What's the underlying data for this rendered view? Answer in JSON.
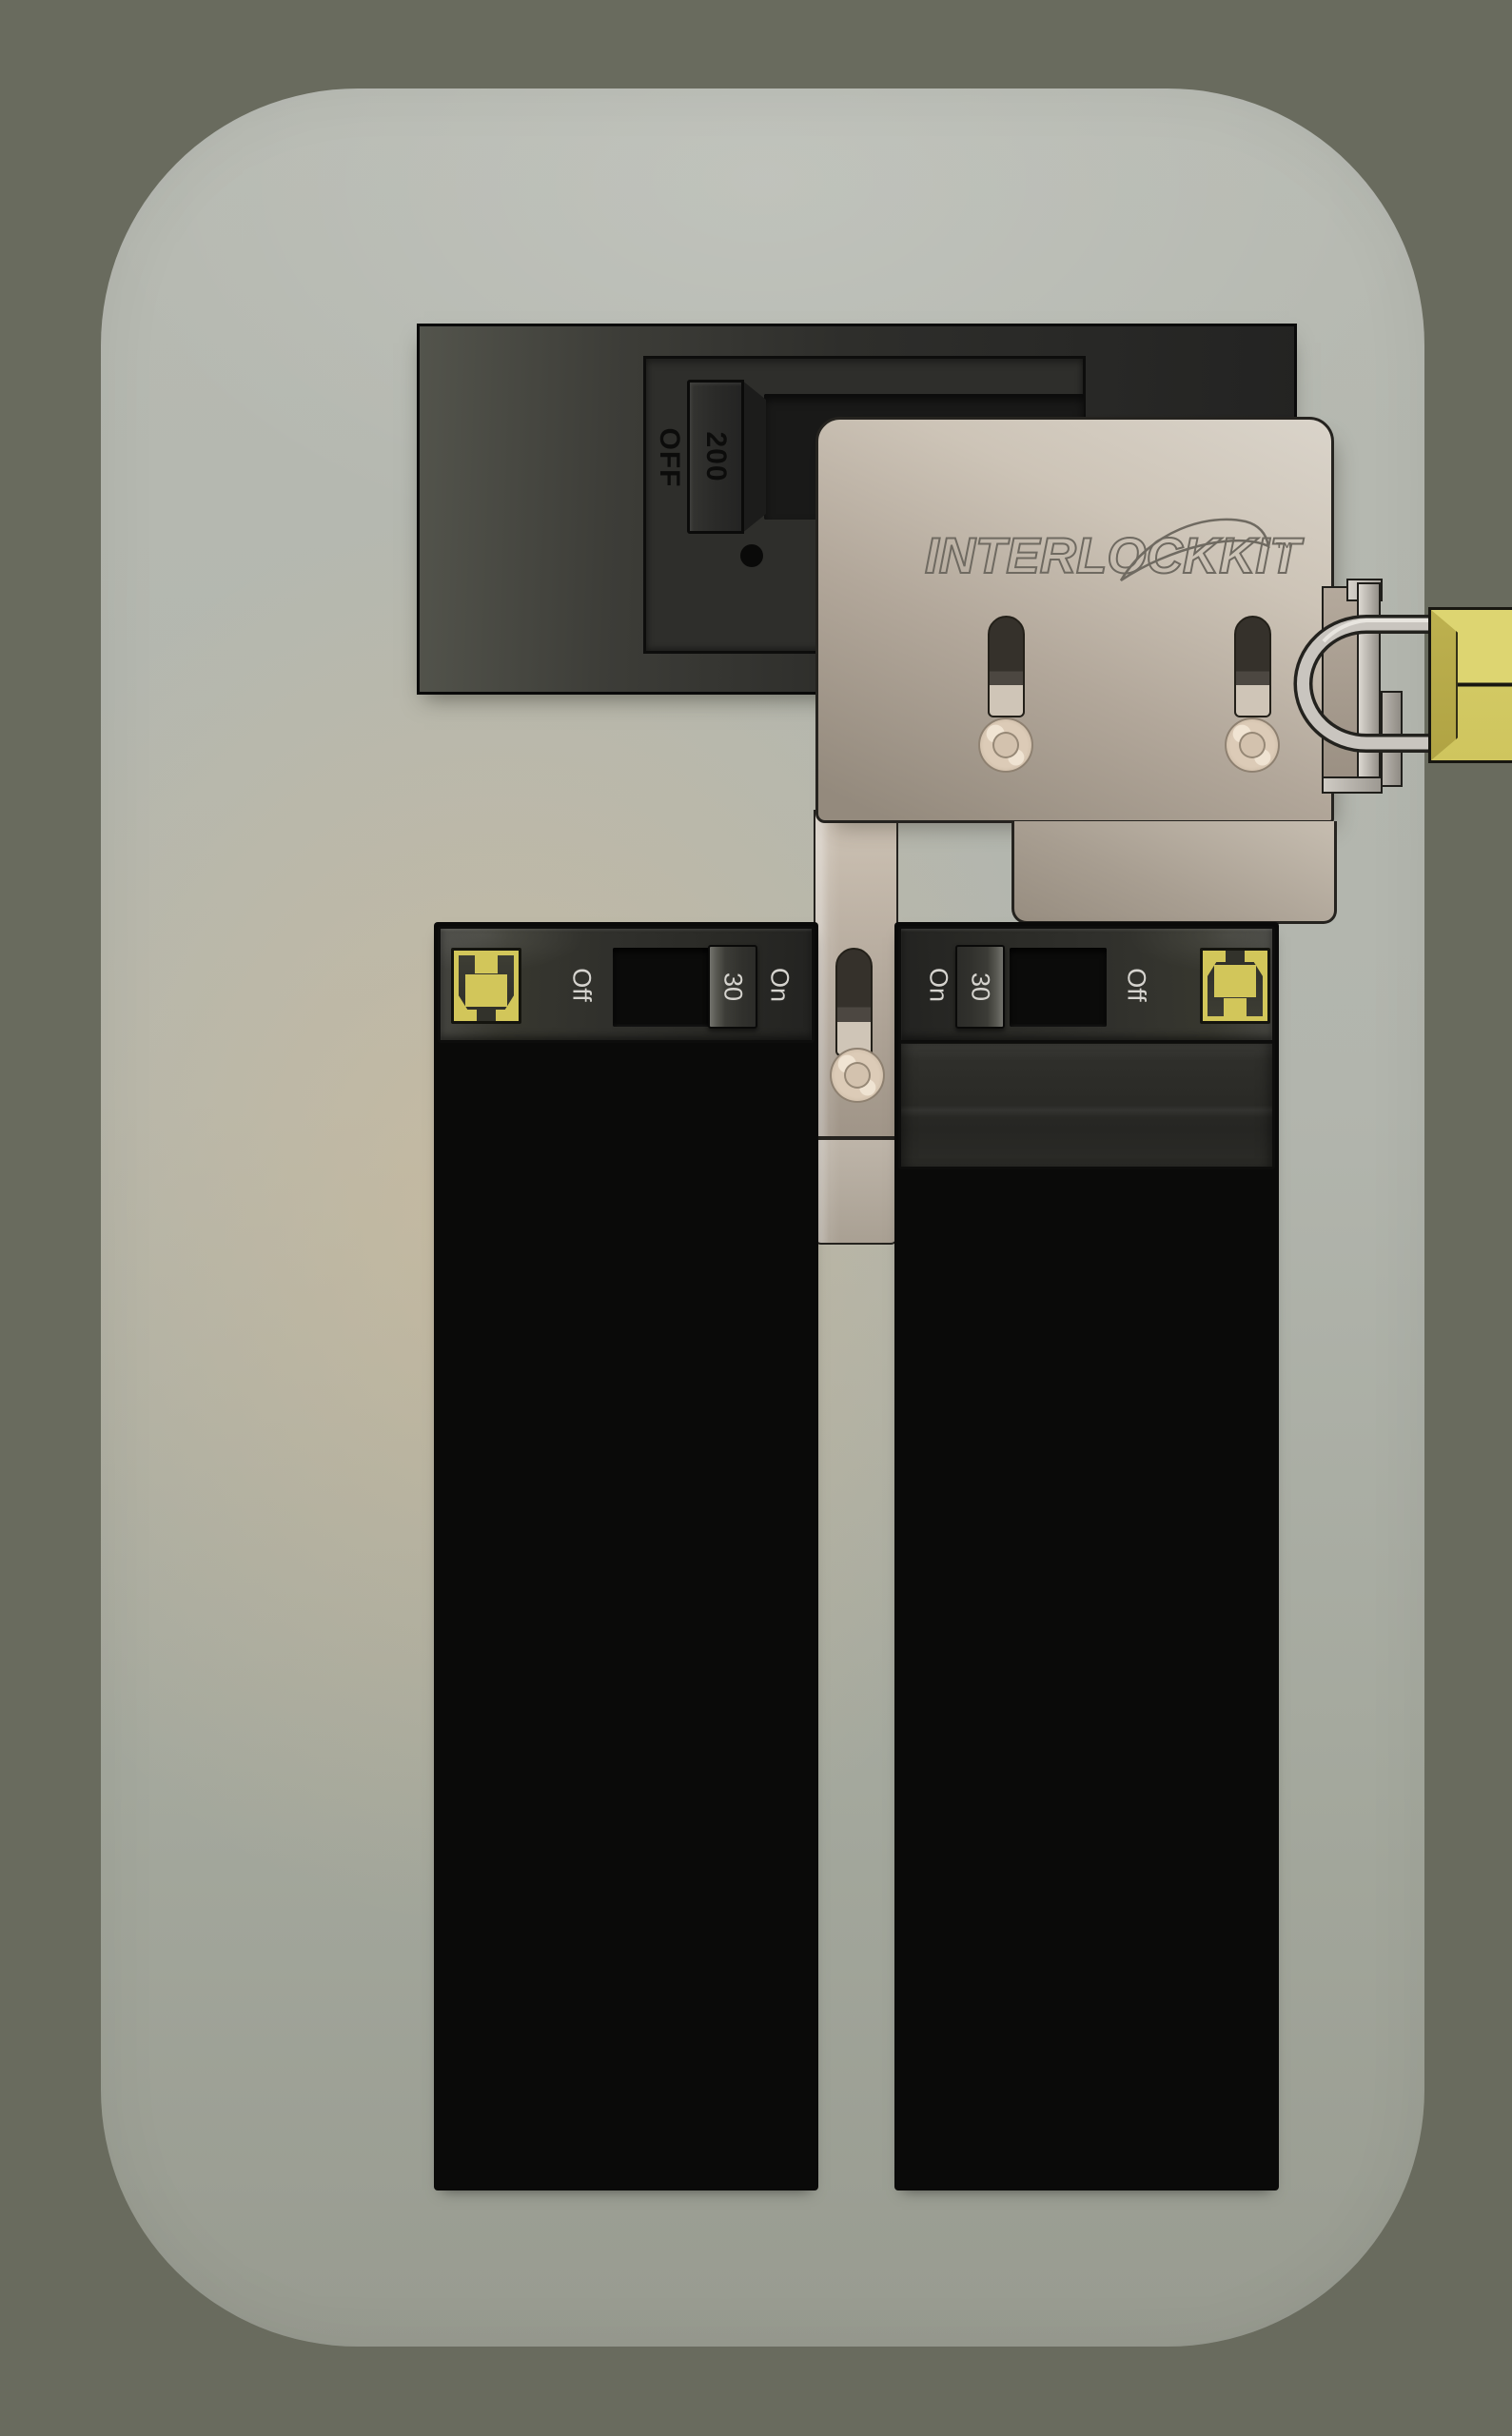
{
  "main_breaker": {
    "rating": "200",
    "state": "OFF"
  },
  "interlock_kit": {
    "brand": "INTERLOCKKIT",
    "trademark": "™"
  },
  "left_column": {
    "units": [
      {
        "type": "single",
        "labels": {
          "left": "Off",
          "center": "30",
          "right": "On"
        }
      },
      {
        "type": "single",
        "labels": {
          "left": "Off",
          "center": "30",
          "right": "On"
        }
      },
      {
        "type": "single",
        "labels": {
          "left": "Off",
          "center": "30",
          "right": "On"
        }
      },
      {
        "type": "single",
        "labels": {
          "left": "Off",
          "center": "30",
          "right": "On"
        }
      },
      {
        "type": "single",
        "labels": {
          "left": "Off",
          "center": "30",
          "right": "On"
        }
      },
      {
        "type": "single",
        "labels": {
          "left": "Off",
          "center": "30",
          "right": "On"
        }
      },
      {
        "type": "single",
        "labels": {
          "left": "Off",
          "center": "30",
          "right": "On"
        }
      },
      {
        "type": "single",
        "labels": {
          "left": "Off",
          "center": "30",
          "right": "On"
        }
      },
      {
        "type": "single",
        "labels": {
          "left": "Off",
          "center": "30",
          "right": "On"
        }
      },
      {
        "type": "single",
        "labels": {
          "left": "Off",
          "center": "30",
          "right": "On"
        }
      }
    ]
  },
  "right_column": {
    "units": [
      {
        "type": "double",
        "labels": {
          "left": "On",
          "center": "30",
          "right": "Off"
        }
      },
      {
        "type": "double",
        "labels": {
          "left": "On",
          "center": "30",
          "right": "Off"
        }
      },
      {
        "type": "double",
        "labels": {
          "left": "On",
          "center": "30",
          "right": "Off"
        }
      },
      {
        "type": "single",
        "labels": {
          "left": "On",
          "center": "30",
          "right": "Off"
        }
      },
      {
        "type": "single",
        "labels": {
          "left": "On",
          "center": "30",
          "right": "Off"
        }
      },
      {
        "type": "single",
        "labels": {
          "left": "On",
          "center": "30",
          "right": "Off"
        }
      },
      {
        "type": "single",
        "labels": {
          "left": "On",
          "center": "30",
          "right": "Off"
        }
      }
    ]
  },
  "colors": {
    "outer_background": "#696b5e",
    "panel_face_light": "#b7bab2",
    "panel_face_dark": "#989b90",
    "panel_warm_tint": "#ccbb9e",
    "breaker_body": "#2e2e2b",
    "breaker_label": "#d6d4cf",
    "icon_yellow": "#d2c65a",
    "interlock_metal": "#b7ab9e",
    "engraving": "#6f6a61",
    "screw_ivory": "#dccbb7",
    "shackle_silver": "#c9c5bf",
    "padlock_brass": "#ddd571",
    "main_breaker_text": "#0c0c0b"
  }
}
